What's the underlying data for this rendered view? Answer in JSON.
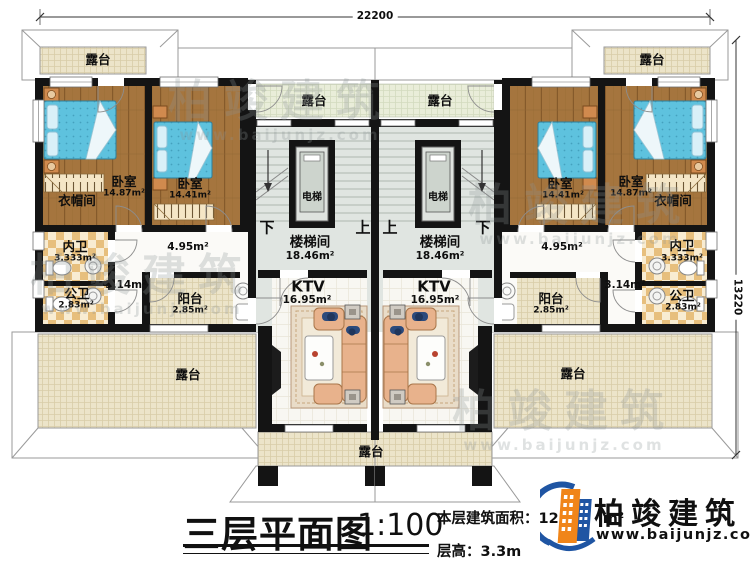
{
  "dimensions": {
    "top": "22200",
    "right": "13220"
  },
  "rooms": {
    "terrace": "露台",
    "bedroom": "卧室",
    "cloakroom": "衣帽间",
    "inner_bathroom": "内卫",
    "public_bathroom": "公卫",
    "balcony": "阳台",
    "elevator": "电梯",
    "stairwell": "楼梯间",
    "ktv": "KTV",
    "up": "上",
    "down": "下"
  },
  "areas": {
    "bedroom_large": "14.87m²",
    "bedroom_small": "14.41m²",
    "inner_bathroom": "3.333m²",
    "public_bathroom": "2.83m²",
    "hall_small": "3.14m²",
    "hall": "4.95m²",
    "balcony": "2.85m²",
    "stairwell": "18.46m²",
    "ktv": "16.95m²"
  },
  "titleblock": {
    "title": "三层平面图",
    "scale": "1:100",
    "area_label": "本层建筑面积：",
    "area_value": "12",
    "area_unit": "m²",
    "height_label": "层高：",
    "height_value": "3.3m"
  },
  "brand": {
    "name": "柏竣建筑",
    "website": "www.baijunjz.com"
  },
  "watermark": {
    "name": "柏竣建筑",
    "website": "www.baijunjz.com"
  }
}
